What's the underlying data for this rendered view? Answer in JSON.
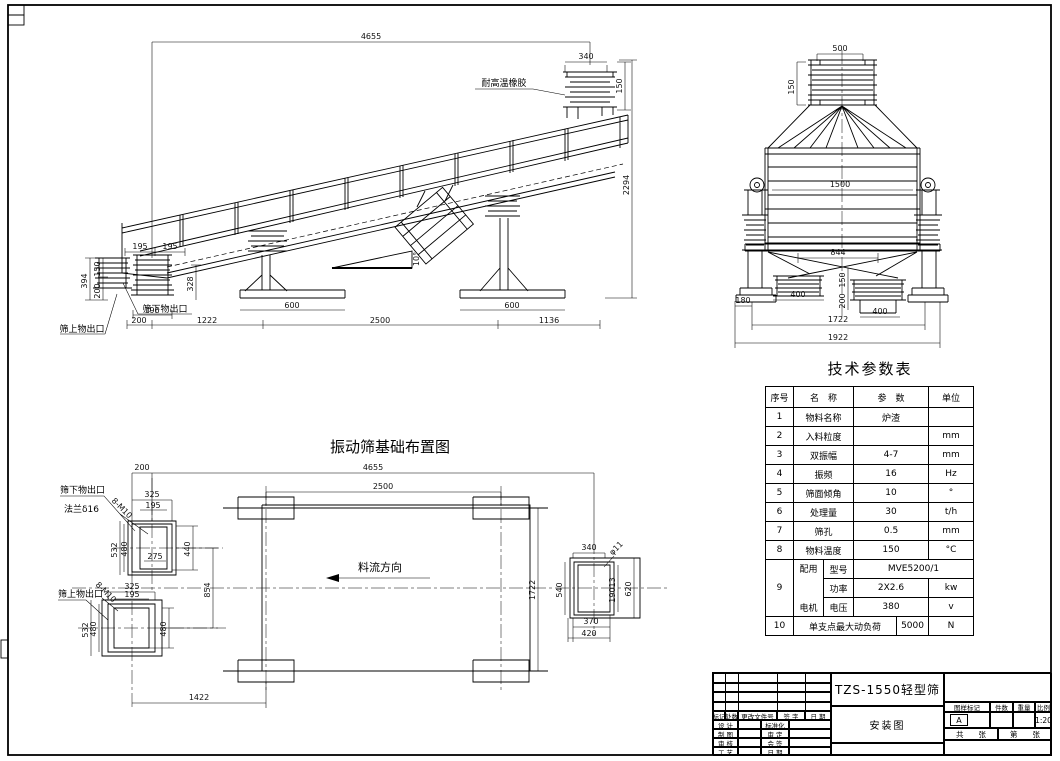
{
  "sheet": {
    "bg": "#ffffff",
    "line": "#000000"
  },
  "side_view": {
    "dims": {
      "overall": "4655",
      "inlet_w": "340",
      "inlet_h": "150",
      "height": "2294",
      "off_a": "195",
      "off_b": "195",
      "left_h1": "394",
      "left_h2": "150",
      "left_h3": "200",
      "chute_h": "328",
      "chute_w": "196",
      "base_l": "600",
      "base_r": "600",
      "span_a": "200",
      "span_b": "1222",
      "span_c": "2500",
      "span_d": "1136",
      "slope": "10°"
    },
    "labels": {
      "rubber": "耐高温橡胶",
      "under_outlet": "筛下物出口",
      "over_outlet": "筛上物出口"
    }
  },
  "end_view": {
    "dims": {
      "inlet_w": "500",
      "inlet_h": "150",
      "body_w": "1500",
      "outlet_span": "844",
      "outlet_l": "400",
      "outlet_r": "400",
      "mid_h1": "150",
      "mid_h2": "200",
      "base_off": "180",
      "span_in": "1722",
      "span_out": "1922"
    }
  },
  "plan_view": {
    "title": "振动筛基础布置图",
    "dims": {
      "offset": "200",
      "overall": "4655",
      "pad_span": "2500",
      "width": "1722",
      "outlet_gap": "854",
      "pad_off": "1422"
    },
    "upper_outlet": {
      "w1": "325",
      "w2": "195",
      "h1": "532",
      "h2": "480",
      "h3": "440",
      "w3": "275",
      "bolts": "8-M10"
    },
    "lower_outlet": {
      "w1": "325",
      "w2": "195",
      "h1": "532",
      "h2": "480",
      "h3": "480",
      "bolts": "8-M10"
    },
    "right_outlet": {
      "w1": "340",
      "h1": "540",
      "h2": "19013",
      "h3": "620",
      "w2": "370",
      "w3": "420",
      "hole": "φ11"
    },
    "labels": {
      "under_outlet": "筛下物出口",
      "flange": "法兰δ16",
      "over_outlet": "筛上物出口",
      "flow": "料流方向"
    }
  },
  "params_table": {
    "title": "技术参数表",
    "headers": {
      "no": "序号",
      "name": "名　称",
      "value": "参　数",
      "unit": "单位"
    },
    "rows": [
      {
        "no": "1",
        "name": "物料名称",
        "value": "炉渣",
        "unit": ""
      },
      {
        "no": "2",
        "name": "入料粒度",
        "value": "",
        "unit": "mm"
      },
      {
        "no": "3",
        "name": "双振幅",
        "value": "4-7",
        "unit": "mm"
      },
      {
        "no": "4",
        "name": "振频",
        "value": "16",
        "unit": "Hz"
      },
      {
        "no": "5",
        "name": "筛面倾角",
        "value": "10",
        "unit": "°"
      },
      {
        "no": "6",
        "name": "处理量",
        "value": "30",
        "unit": "t/h"
      },
      {
        "no": "7",
        "name": "筛孔",
        "value": "0.5",
        "unit": "mm"
      },
      {
        "no": "8",
        "name": "物料温度",
        "value": "150",
        "unit": "°C"
      }
    ],
    "motor": {
      "no": "9",
      "group_top": "配用",
      "group_bottom": "电机",
      "model_label": "型号",
      "model_value": "MVE5200/1",
      "power_label": "功率",
      "power_value": "2X2.6",
      "power_unit": "kw",
      "voltage_label": "电压",
      "voltage_value": "380",
      "voltage_unit": "v"
    },
    "last_row": {
      "no": "10",
      "name": "单支点最大动负荷",
      "value": "5000",
      "unit": "N"
    }
  },
  "title_block": {
    "product": "TZS-1550轻型筛",
    "doc_type": "安装图",
    "rev_cols": {
      "mark": "标记",
      "count": "处数",
      "file": "更改文件号",
      "sign": "签 字",
      "date": "日 期"
    },
    "roles": {
      "design": "设 计",
      "draft": "制 图",
      "check": "审 核",
      "process": "工 艺",
      "standard": "标准化",
      "approve": "审 定",
      "countersign": "会 签",
      "date": "日 期"
    },
    "info": {
      "mark_label": "图样标记",
      "qty_label": "件数",
      "weight_label": "重量",
      "scale_label": "比例",
      "mark_value": "A",
      "scale_value": "1:20",
      "total": "共　　张",
      "sheet": "第　　张"
    }
  }
}
